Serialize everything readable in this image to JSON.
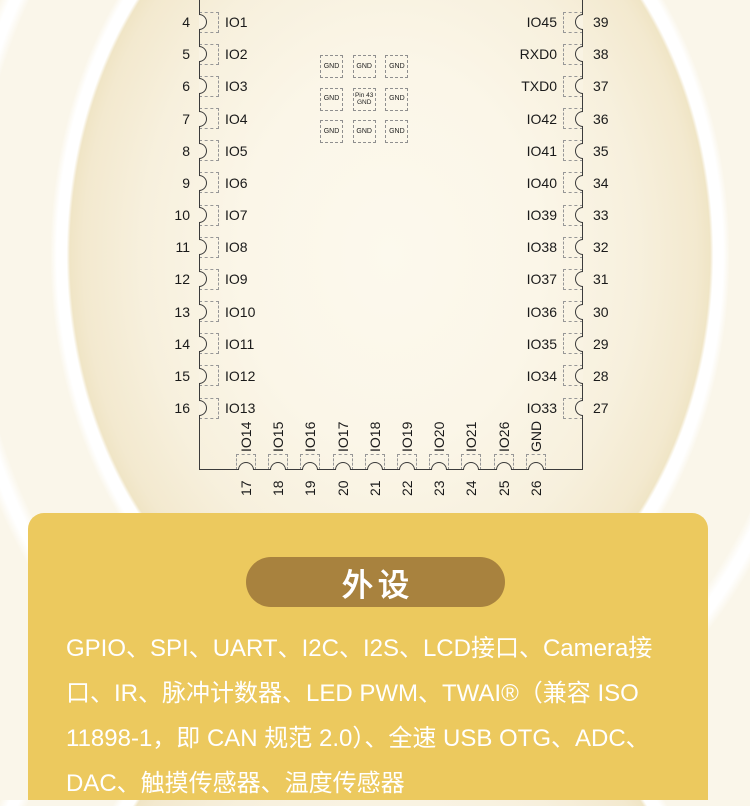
{
  "diagram": {
    "left_pins": [
      {
        "num": "4",
        "label": "IO1"
      },
      {
        "num": "5",
        "label": "IO2"
      },
      {
        "num": "6",
        "label": "IO3"
      },
      {
        "num": "7",
        "label": "IO4"
      },
      {
        "num": "8",
        "label": "IO5"
      },
      {
        "num": "9",
        "label": "IO6"
      },
      {
        "num": "10",
        "label": "IO7"
      },
      {
        "num": "11",
        "label": "IO8"
      },
      {
        "num": "12",
        "label": "IO9"
      },
      {
        "num": "13",
        "label": "IO10"
      },
      {
        "num": "14",
        "label": "IO11"
      },
      {
        "num": "15",
        "label": "IO12"
      },
      {
        "num": "16",
        "label": "IO13"
      }
    ],
    "right_pins": [
      {
        "num": "39",
        "label": "IO45"
      },
      {
        "num": "38",
        "label": "RXD0"
      },
      {
        "num": "37",
        "label": "TXD0"
      },
      {
        "num": "36",
        "label": "IO42"
      },
      {
        "num": "35",
        "label": "IO41"
      },
      {
        "num": "34",
        "label": "IO40"
      },
      {
        "num": "33",
        "label": "IO39"
      },
      {
        "num": "32",
        "label": "IO38"
      },
      {
        "num": "31",
        "label": "IO37"
      },
      {
        "num": "30",
        "label": "IO36"
      },
      {
        "num": "29",
        "label": "IO35"
      },
      {
        "num": "28",
        "label": "IO34"
      },
      {
        "num": "27",
        "label": "IO33"
      }
    ],
    "bottom_pins": [
      {
        "num": "17",
        "label": "IO14"
      },
      {
        "num": "18",
        "label": "IO15"
      },
      {
        "num": "19",
        "label": "IO16"
      },
      {
        "num": "20",
        "label": "IO17"
      },
      {
        "num": "21",
        "label": "IO18"
      },
      {
        "num": "22",
        "label": "IO19"
      },
      {
        "num": "23",
        "label": "IO20"
      },
      {
        "num": "24",
        "label": "IO21"
      },
      {
        "num": "25",
        "label": "IO26"
      },
      {
        "num": "26",
        "label": "GND"
      }
    ],
    "gnd_pads": [
      "GND",
      "GND",
      "GND",
      "GND",
      "Pin 43\nGND",
      "GND",
      "GND",
      "GND",
      "GND"
    ]
  },
  "card": {
    "title": "外设",
    "description": "GPIO、SPI、UART、I2C、I2S、LCD接口、Camera接口、IR、脉冲计数器、LED PWM、TWAI®（兼容 ISO 11898-1，即 CAN 规范 2.0）、全速 USB OTG、ADC、DAC、触摸传感器、温度传感器",
    "colors": {
      "card_bg": "#ecc95e",
      "pill_bg": "#a8823e",
      "text": "#ffffff",
      "outline": "#3b3b3b"
    }
  }
}
